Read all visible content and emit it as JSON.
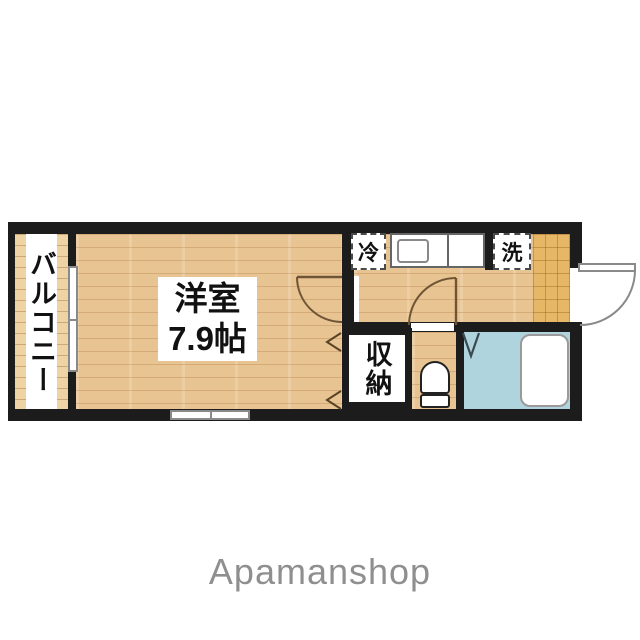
{
  "floorplan": {
    "labels": {
      "balcony": "バルコニー",
      "room_name": "洋室",
      "room_size": "7.9帖",
      "refrigerator": "冷",
      "washer": "洗",
      "storage": "収納"
    },
    "colors": {
      "wall": "#1c1c1c",
      "wood_floor": "#e9c493",
      "balcony_deck": "#eed3a4",
      "entry_tile": "#e6b766",
      "bath_floor": "#b0d4dd",
      "door_arc": "#6f5535",
      "window_frame": "#8a8a8a",
      "label_text": "#111111"
    }
  },
  "footer": {
    "brand": "Apamanshop",
    "color": "#8f8f8f"
  }
}
